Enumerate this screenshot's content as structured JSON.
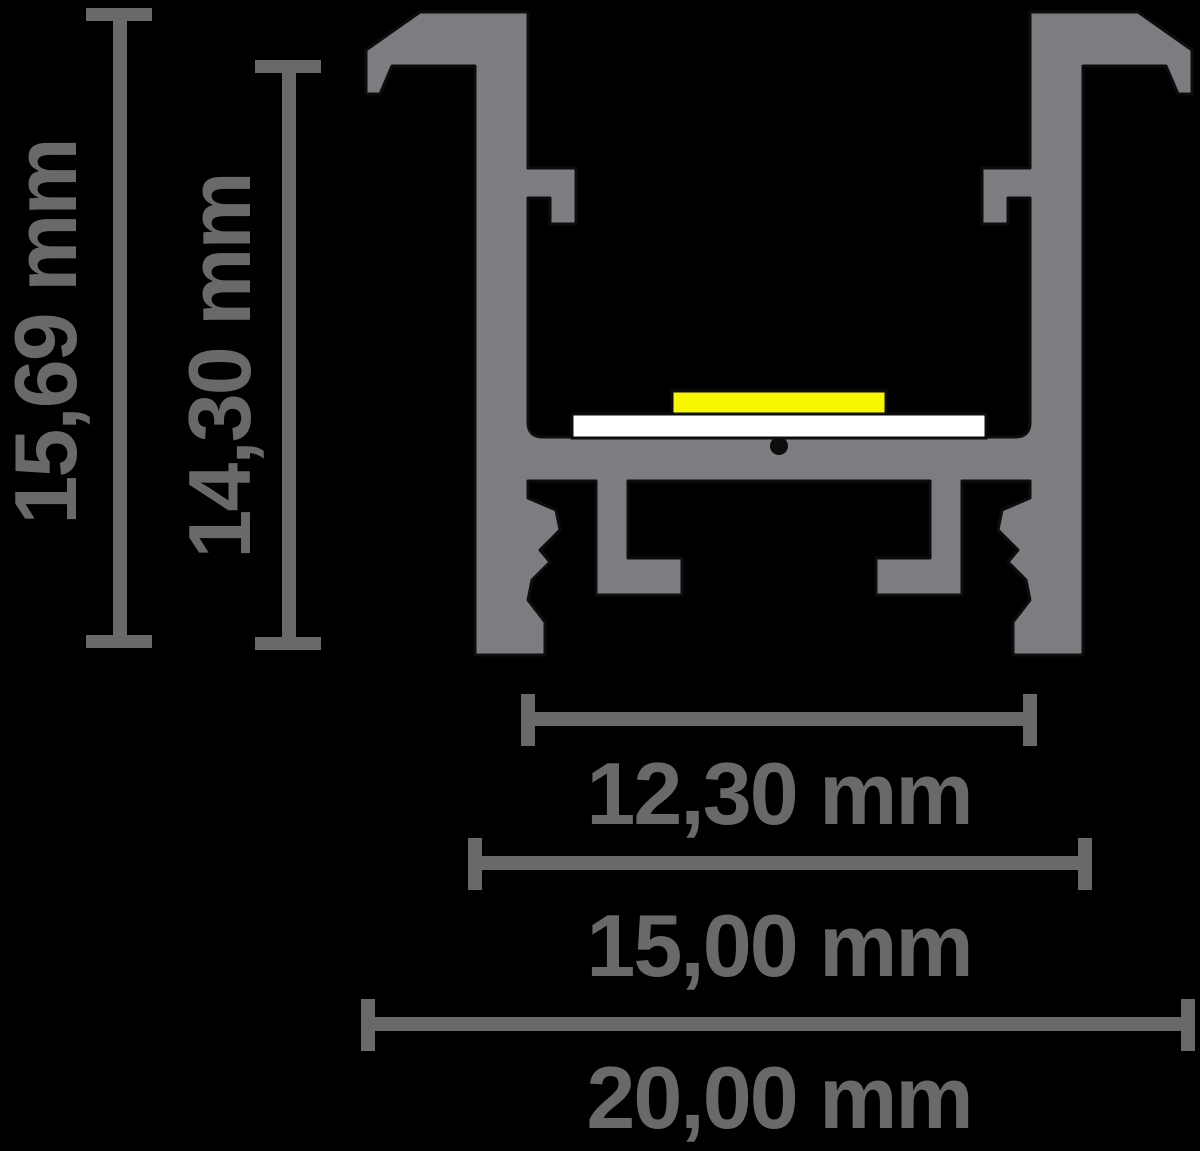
{
  "diagram": {
    "title": "led-aluminium-profile-cross-section",
    "unit": "mm",
    "colors": {
      "background": "#000000",
      "profile": "#7d7d81",
      "dimension": "#696969",
      "led_strip": "#f7f700",
      "pcb": "#ffffff",
      "outline": "#0d0d0d"
    },
    "dimensions": {
      "overall_height": {
        "label": "15,69 mm",
        "value": 15.69,
        "orientation": "vertical"
      },
      "inner_height": {
        "label": "14,30 mm",
        "value": 14.3,
        "orientation": "vertical"
      },
      "inner_width": {
        "label": "12,30 mm",
        "value": 12.3,
        "orientation": "horizontal"
      },
      "body_width": {
        "label": "15,00 mm",
        "value": 15.0,
        "orientation": "horizontal"
      },
      "overall_width": {
        "label": "20,00 mm",
        "value": 20.0,
        "orientation": "horizontal"
      }
    }
  }
}
